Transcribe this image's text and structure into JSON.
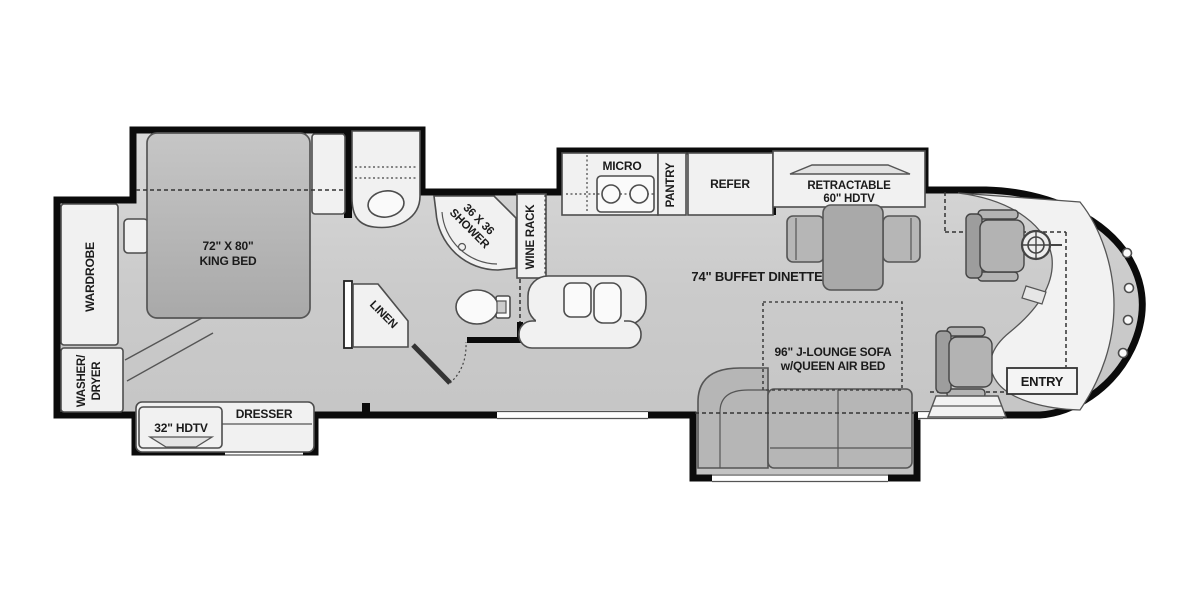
{
  "title": "RV motorhome floor plan",
  "colors": {
    "wall": "#0b0b0b",
    "floor_light": "#d9d9d9",
    "floor_dark": "#c3c3c3",
    "furniture": "#f1f1f1",
    "cushion": "#b6b6b6",
    "text": "#1b1b1b"
  },
  "labels": {
    "wardrobe": "WARDROBE",
    "washer_dryer_line1": "WASHER/",
    "washer_dryer_line2": "DRYER",
    "king_bed_line1": "72\" X 80\"",
    "king_bed_line2": "KING BED",
    "dresser": "DRESSER",
    "tv32": "32\" HDTV",
    "linen": "LINEN",
    "shower_line1": "36 X 36",
    "shower_line2": "SHOWER",
    "wine_rack": "WINE RACK",
    "micro": "MICRO",
    "pantry": "PANTRY",
    "refer": "REFER",
    "retractable_line1": "RETRACTABLE",
    "retractable_line2": "60\" HDTV",
    "dinette": "74\" BUFFET DINETTE",
    "sofa_line1": "96\" J-LOUNGE SOFA",
    "sofa_line2": "w/QUEEN AIR BED",
    "entry": "ENTRY"
  }
}
